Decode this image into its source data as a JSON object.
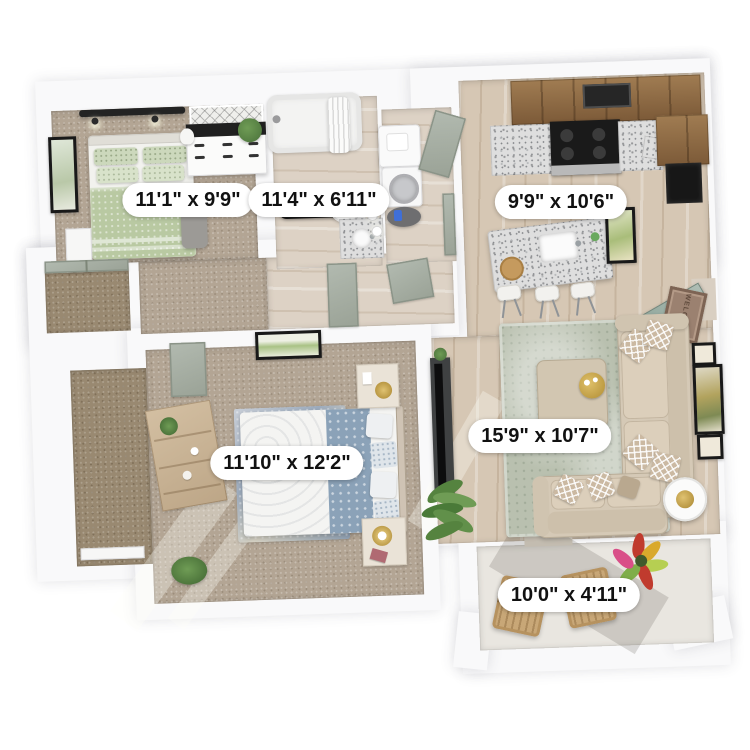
{
  "floorplan": {
    "type": "apartment-3d-floorplan",
    "rooms": [
      {
        "name": "bedroom-1",
        "dimensions": "11'1\" x 9'9\""
      },
      {
        "name": "bathroom",
        "dimensions": "11'4\" x 6'11\""
      },
      {
        "name": "kitchen",
        "dimensions": "9'9\" x 10'6\""
      },
      {
        "name": "bedroom-2",
        "dimensions": "11'10\" x 12'2\""
      },
      {
        "name": "living-room",
        "dimensions": "15'9\" x 10'7\""
      },
      {
        "name": "balcony",
        "dimensions": "10'0\" x 4'11\""
      }
    ],
    "labels": {
      "bedroom1": "11'1\" x 9'9\"",
      "bathroom": "11'4\" x 6'11\"",
      "kitchen": "9'9\" x 10'6\"",
      "bedroom2": "11'10\" x 12'2\"",
      "living": "15'9\" x 10'7\"",
      "balcony": "10'0\" x 4'11\""
    },
    "mat_text": "WELCOME"
  },
  "palette": {
    "wall": "#f9f9fa",
    "carpet": "#b3a594",
    "carpetdark": "#998971",
    "woodfloor": "#d6c7b4",
    "woodcab": "#8f6c46",
    "granite": "#dedede",
    "sage": "#a9b1a1",
    "greenbed": "#b9c9a2",
    "bluebed": "#8ba2b8",
    "sofa": "#d5c9b6",
    "rug": "#b9c0af",
    "gold": "#c9a84c",
    "balconyfloor": "#e9e6e0",
    "labelbg": "#ffffff",
    "labeltext": "#111111"
  }
}
